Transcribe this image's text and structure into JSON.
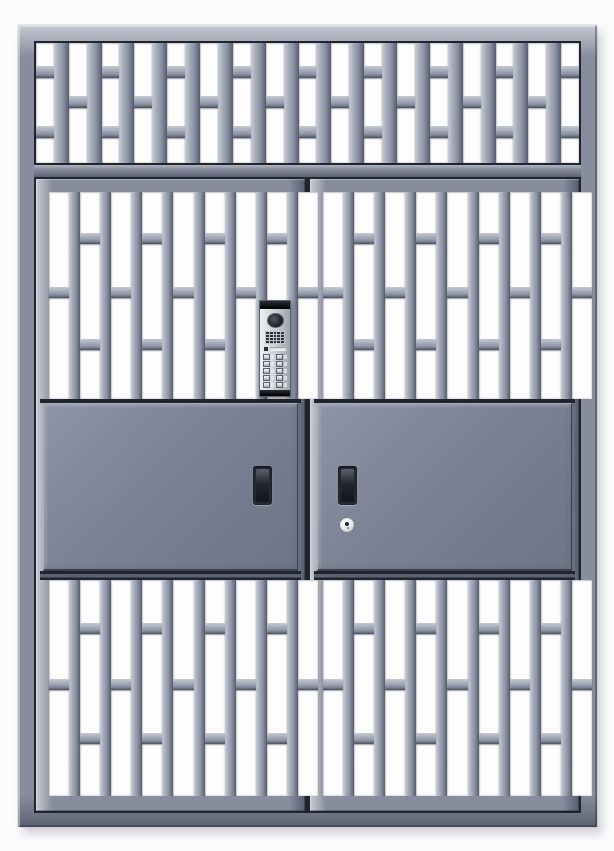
{
  "meta": {
    "subject": "steel security double entry door with barred transom, grille panels, solid mid panels and video intercom",
    "visible_text": ""
  },
  "colors": {
    "bg": "#fbfbfc",
    "frame-face": "#878d9d",
    "frame-hi": "#c6c9d1",
    "frame-hi2": "#b2b6c0",
    "frame-lo": "#5c6271",
    "outline-dark": "#20242e",
    "bar-hi": "#c8ccd4",
    "bar-mid1": "#a4aab8",
    "bar-mid2": "#8a91a2",
    "bar-lo": "#575d6e",
    "tab-hi": "#c4c8d0",
    "tab-lo": "#4a5060",
    "slot-white": "#fdfdfe",
    "panel-face": "#7b8294",
    "panel-hi": "#8e94a5",
    "panel-lo": "#6d7486",
    "panel-edge-hi": "#aab0bc",
    "panel-edge-lo": "#3c414e",
    "handle-rim": "#262a33",
    "cavity-hi": "#5a5f6c",
    "cavity-mid": "#23262e",
    "cavity-lo": "#13151c",
    "key-face": "#e2e4e9",
    "key-edge": "#a2a7b2",
    "key-ring": "#787d89",
    "ic-hi": "#eef0f2",
    "ic-mid": "#c9ccd2",
    "ic-lo": "#9da2ac",
    "ic-border": "#5f636e",
    "ic-cap": "#17181d",
    "ic-plate": "#c2c5cb",
    "ic-hole": "#2a2d37",
    "ic-slot": "#e8eaed",
    "ic-btn": "#ccd0d6",
    "ic-btn-border": "#596070",
    "cam-hi": "#555a67",
    "cam-mid": "#262933",
    "cam-lo": "#101218"
  },
  "structure": {
    "transom_grille": {
      "slots": 17,
      "bar_w": 15,
      "tab_h": 12,
      "first": "double",
      "tabs": {
        "single": [
          44
        ],
        "double": [
          19,
          69
        ]
      }
    },
    "door_grille": {
      "slots": 9,
      "bar_w": 11,
      "tab_h": 11,
      "first": "single",
      "tabs": {
        "single": [
          46
        ],
        "double": [
          20,
          71
        ]
      }
    },
    "intercom": {
      "speaker_rows": 4,
      "speaker_cols": 5,
      "button_rows": 5,
      "button_cols": 2,
      "button_count": 10
    }
  },
  "components": {
    "transom": "fixed transom grille with staggered brick-pattern bars",
    "left_door": {
      "handle": "recessed pull handle",
      "lock": ""
    },
    "right_door": {
      "handle": "recessed pull handle",
      "lock": "round cylinder keyhole"
    },
    "intercom": "multi-tenant video intercom with camera, speaker grille, indicator and 10 call buttons"
  }
}
